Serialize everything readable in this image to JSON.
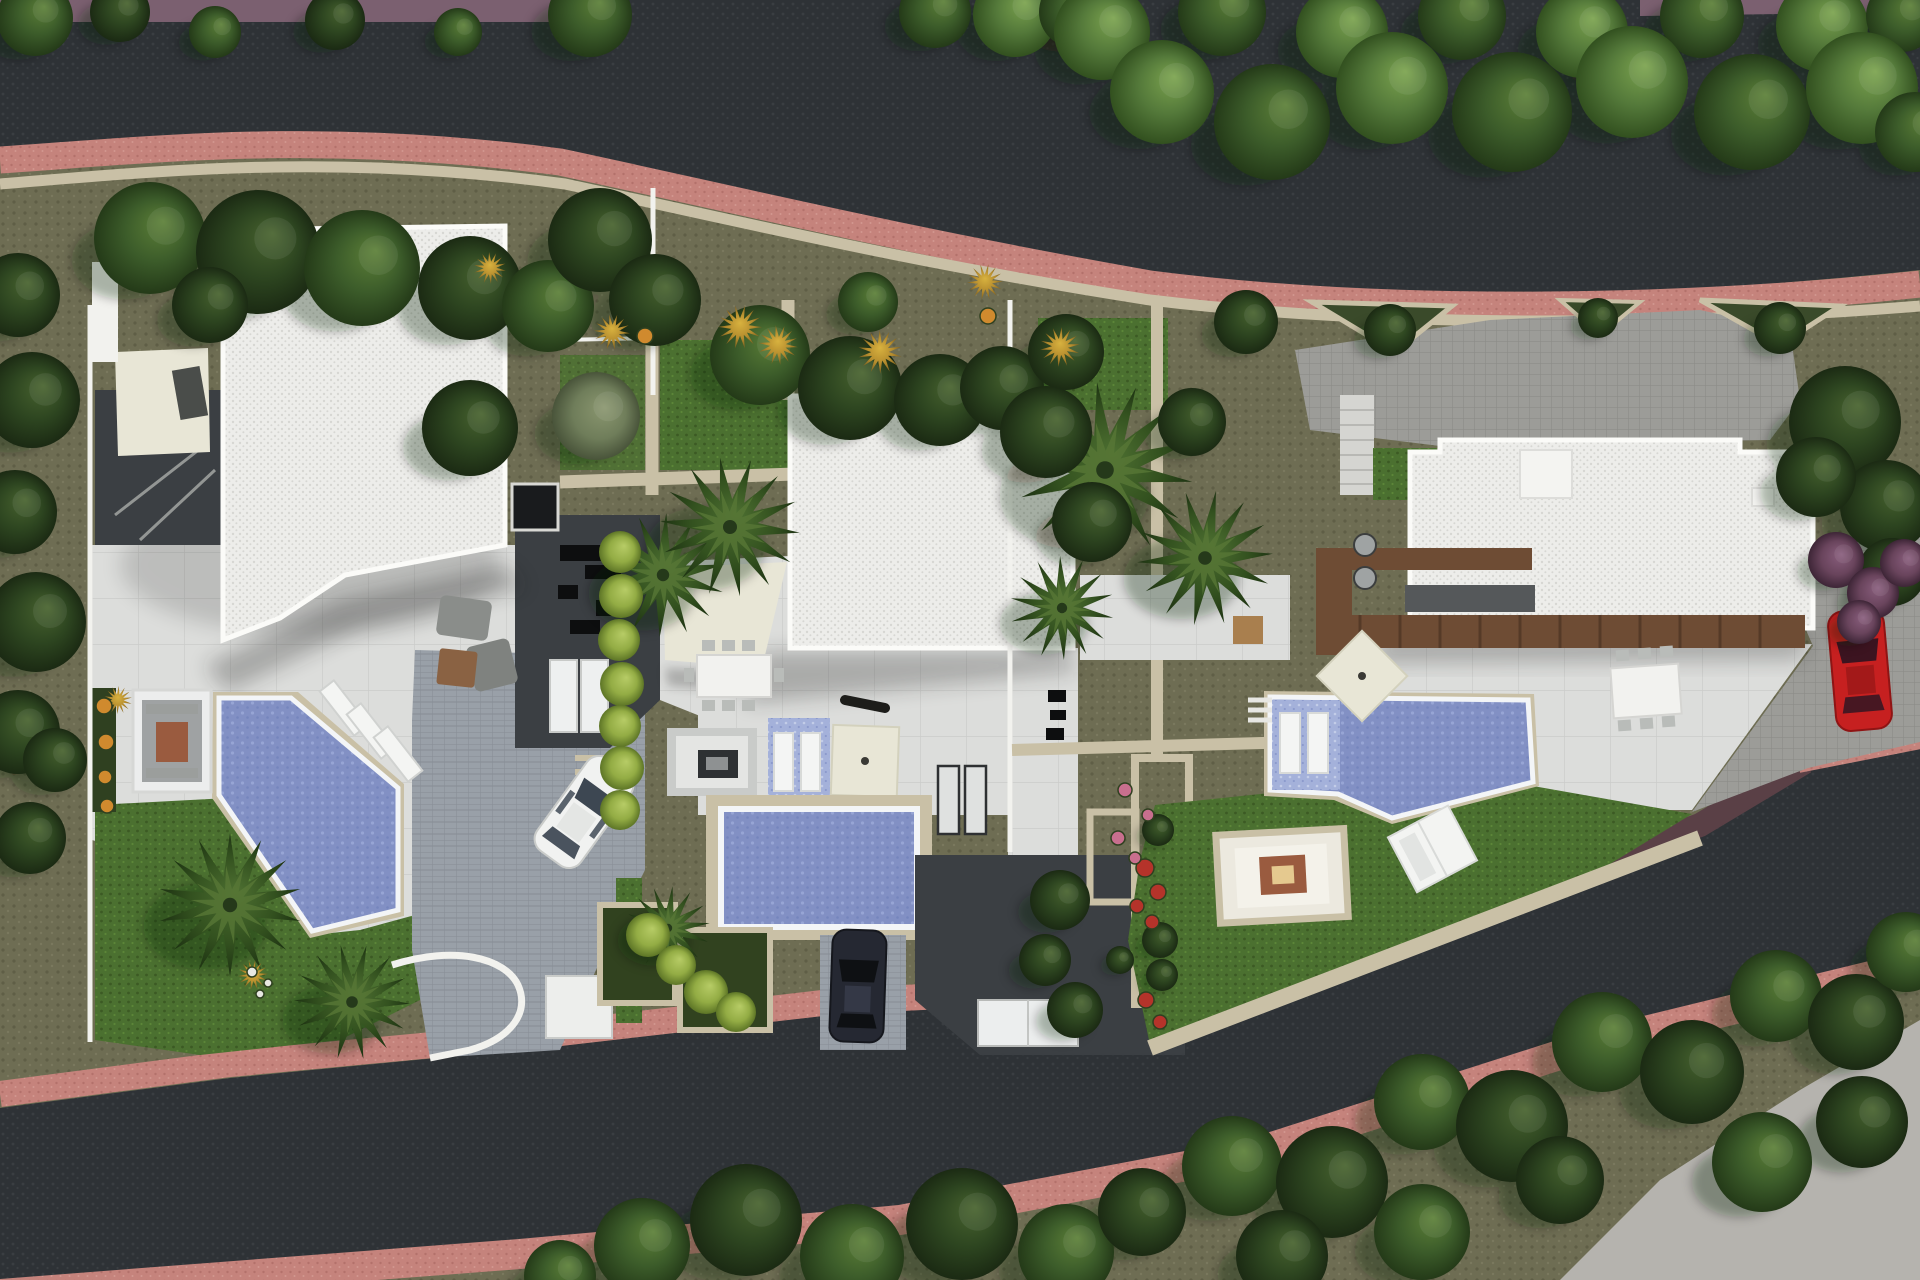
{
  "meta": {
    "type": "architectural-aerial-render",
    "description": "Top-down 3D rendering of a residential site plan: three modern white flat-roof villas with angular blue pools, lawns, palm trees, paved terraces, driveways with parked cars, bounded by two curving asphalt roads with salmon-pink sidewalks and dense tree lines.",
    "width": 1920,
    "height": 1280
  },
  "palette": {
    "asphalt": "#2e3236",
    "asphaltDot": "#3a3e42",
    "sidewalkPink": "#c5837c",
    "sidewalkPinkDark": "#b3716b",
    "boundaryMaroon": "#5a4046",
    "pathPurple": "#7b6070",
    "stoneBeige": "#c9c0a6",
    "stoneBright": "#d9d1b9",
    "groundOlive": "#6e6d53",
    "groundOliveDot": "#5f5e46",
    "shadedGarden": "#232d1a",
    "lawn": "#4b7030",
    "lawnDark": "#3c5a24",
    "lawnLight": "#5c8638",
    "roofWhite": "#EDEDEA",
    "roofDot": "#d7d7d3",
    "roofFascia": "#fbfbf8",
    "terrace": "#DCDDDB",
    "terraceLine": "#cbccca",
    "paverGray": "#9c9c98",
    "paverLine": "#8b8b87",
    "paverCool": "#99a0a8",
    "paverCoolLine": "#868d95",
    "courtDark": "#3b3f43",
    "skylight": "#191b1d",
    "water": "#8290c4",
    "waterDot": "#97a5d4",
    "splash": "#a4b1da",
    "poolRim": "#f3f5f7",
    "concreteLight": "#b5b3ae",
    "wood": "#6e4c34",
    "woodLight": "#8a6243",
    "rustFire": "#9a5b3f",
    "canvasCream": "#e8e6d6",
    "carWhite": "#f1f2f1",
    "carDark": "#252832",
    "carRed": "#c62020",
    "wallWhite": "#f2f2ee",
    "furnGray": "#85888a"
  },
  "scene": {
    "roads": {
      "upper": {
        "surface": "dark asphalt",
        "sidewalk": "salmon pink strip on lower edge",
        "edge_wall": "beige stone"
      },
      "lower": {
        "surface": "dark asphalt",
        "sidewalk": "salmon pink strips both edges",
        "edge_wall": "dark maroon boundary wall"
      }
    },
    "villas": [
      {
        "id": "left",
        "roof": "white gravel flat roof",
        "pool": "angular diagonal pool",
        "features": [
          "sunken fire-pit lounge",
          "three sun loungers",
          "carport canopy",
          "paver driveway",
          "white compact car",
          "palm lawn"
        ]
      },
      {
        "id": "middle",
        "roof": "large white gravel flat roof",
        "pool": "rectangular pool with tiled splash deck",
        "features": [
          "shade sail",
          "outdoor dining table",
          "lounge with fire table",
          "square parasol",
          "dark car on driveway",
          "hedge row"
        ]
      },
      {
        "id": "right",
        "roof": "L-shaped white gravel flat roof",
        "pool": "angular infinity pool with splash deck",
        "features": [
          "timber pergola",
          "outdoor dining table",
          "sunken fire-pit lounge",
          "double sun lounger",
          "gray paver parking",
          "red car"
        ]
      }
    ],
    "cars": [
      {
        "id": "white-car",
        "color": "white",
        "transform": "translate(584,812) rotate(36)"
      },
      {
        "id": "dark-car",
        "color": "dark navy",
        "transform": "translate(858,986) rotate(2)"
      },
      {
        "id": "red-car",
        "color": "red",
        "transform": "translate(1860,670) rotate(-5)"
      }
    ],
    "vegetation": {
      "trees": [
        [
          35,
          18,
          38,
          1
        ],
        [
          120,
          12,
          30,
          0
        ],
        [
          215,
          32,
          26,
          1
        ],
        [
          335,
          20,
          30,
          0
        ],
        [
          458,
          32,
          24,
          1
        ],
        [
          590,
          15,
          42,
          1
        ],
        [
          935,
          12,
          36,
          1
        ],
        [
          1015,
          15,
          42,
          2
        ],
        [
          1075,
          12,
          36,
          1
        ],
        [
          1102,
          32,
          48,
          2
        ],
        [
          1222,
          12,
          44,
          1
        ],
        [
          1342,
          32,
          46,
          2
        ],
        [
          1462,
          16,
          44,
          1
        ],
        [
          1582,
          32,
          46,
          2
        ],
        [
          1702,
          16,
          42,
          1
        ],
        [
          1822,
          26,
          46,
          2
        ],
        [
          1902,
          16,
          36,
          1
        ],
        [
          1162,
          92,
          52,
          2
        ],
        [
          1272,
          122,
          58,
          1
        ],
        [
          1392,
          88,
          56,
          2
        ],
        [
          1512,
          112,
          60,
          1
        ],
        [
          1632,
          82,
          56,
          2
        ],
        [
          1752,
          112,
          58,
          1
        ],
        [
          1862,
          88,
          56,
          2
        ],
        [
          1915,
          132,
          40,
          1
        ],
        [
          18,
          295,
          42,
          0
        ],
        [
          32,
          400,
          48,
          0
        ],
        [
          15,
          512,
          42,
          0
        ],
        [
          36,
          622,
          50,
          0
        ],
        [
          18,
          732,
          42,
          0
        ],
        [
          30,
          838,
          36,
          0
        ],
        [
          55,
          760,
          32,
          0
        ],
        [
          150,
          238,
          56,
          1
        ],
        [
          258,
          252,
          62,
          0
        ],
        [
          362,
          268,
          58,
          1
        ],
        [
          470,
          288,
          52,
          0
        ],
        [
          548,
          306,
          46,
          1
        ],
        [
          210,
          305,
          38,
          0
        ],
        [
          600,
          240,
          52,
          0
        ],
        [
          655,
          300,
          46,
          0
        ],
        [
          760,
          355,
          50,
          1
        ],
        [
          850,
          388,
          52,
          0
        ],
        [
          940,
          400,
          46,
          0
        ],
        [
          1002,
          388,
          42,
          0
        ],
        [
          1066,
          352,
          38,
          0
        ],
        [
          868,
          302,
          30,
          1
        ],
        [
          596,
          416,
          44,
          3
        ],
        [
          470,
          428,
          48,
          0
        ],
        [
          1046,
          432,
          46,
          0
        ],
        [
          1092,
          522,
          40,
          0
        ],
        [
          1192,
          422,
          34,
          0
        ],
        [
          1246,
          322,
          32,
          0
        ],
        [
          1390,
          330,
          26,
          0
        ],
        [
          1780,
          328,
          26,
          0
        ],
        [
          1598,
          318,
          20,
          0
        ],
        [
          1845,
          422,
          56,
          0
        ],
        [
          1886,
          506,
          46,
          0
        ],
        [
          1816,
          477,
          40,
          0
        ],
        [
          1892,
          572,
          34,
          0
        ],
        [
          1836,
          560,
          28,
          4
        ],
        [
          1873,
          593,
          26,
          4
        ],
        [
          1904,
          563,
          24,
          4
        ],
        [
          1859,
          622,
          22,
          4
        ],
        [
          642,
          1246,
          48,
          1
        ],
        [
          746,
          1220,
          56,
          0
        ],
        [
          852,
          1256,
          52,
          1
        ],
        [
          962,
          1224,
          56,
          0
        ],
        [
          1066,
          1252,
          48,
          1
        ],
        [
          1142,
          1212,
          44,
          0
        ],
        [
          560,
          1276,
          36,
          1
        ],
        [
          1232,
          1166,
          50,
          1
        ],
        [
          1332,
          1182,
          56,
          0
        ],
        [
          1422,
          1102,
          48,
          1
        ],
        [
          1512,
          1126,
          56,
          0
        ],
        [
          1602,
          1042,
          50,
          1
        ],
        [
          1692,
          1072,
          52,
          0
        ],
        [
          1776,
          996,
          46,
          1
        ],
        [
          1856,
          1022,
          48,
          0
        ],
        [
          1906,
          952,
          40,
          1
        ],
        [
          1762,
          1162,
          50,
          1
        ],
        [
          1862,
          1122,
          46,
          0
        ],
        [
          1282,
          1256,
          46,
          0
        ],
        [
          1422,
          1232,
          48,
          1
        ],
        [
          1560,
          1180,
          44,
          0
        ],
        [
          1160,
          940,
          18,
          0
        ],
        [
          1162,
          975,
          16,
          0
        ],
        [
          1158,
          830,
          16,
          0
        ],
        [
          1120,
          960,
          14,
          0
        ],
        [
          1060,
          900,
          30,
          0
        ],
        [
          1045,
          960,
          26,
          0
        ],
        [
          1075,
          1010,
          28,
          0
        ]
      ],
      "palms": [
        [
          230,
          905,
          72
        ],
        [
          352,
          1002,
          58
        ],
        [
          663,
          575,
          62
        ],
        [
          730,
          527,
          70
        ],
        [
          668,
          928,
          42
        ],
        [
          1105,
          470,
          88
        ],
        [
          1205,
          558,
          68
        ],
        [
          1062,
          608,
          52
        ]
      ],
      "shrubs": [
        [
          620,
          552,
          21,
          0
        ],
        [
          621,
          596,
          22,
          0
        ],
        [
          619,
          640,
          21,
          0
        ],
        [
          622,
          684,
          22,
          0
        ],
        [
          620,
          726,
          21,
          0
        ],
        [
          622,
          768,
          22,
          0
        ],
        [
          620,
          810,
          20,
          0
        ],
        [
          648,
          935,
          22,
          0
        ],
        [
          676,
          965,
          20,
          0
        ],
        [
          706,
          992,
          22,
          0
        ],
        [
          736,
          1012,
          20,
          0
        ],
        [
          740,
          327,
          22,
          1
        ],
        [
          778,
          345,
          20,
          1
        ],
        [
          880,
          352,
          22,
          1
        ],
        [
          1060,
          347,
          20,
          1
        ],
        [
          985,
          282,
          18,
          1
        ],
        [
          612,
          332,
          18,
          1
        ],
        [
          490,
          268,
          16,
          1
        ],
        [
          118,
          700,
          14,
          1
        ],
        [
          253,
          975,
          15,
          1
        ]
      ],
      "flowers": [
        [
          104,
          706,
          8,
          0
        ],
        [
          106,
          742,
          8,
          0
        ],
        [
          105,
          777,
          7,
          0
        ],
        [
          107,
          806,
          7,
          0
        ],
        [
          645,
          336,
          8,
          0
        ],
        [
          988,
          316,
          8,
          0
        ],
        [
          1145,
          868,
          9,
          1
        ],
        [
          1158,
          892,
          8,
          1
        ],
        [
          1137,
          906,
          7,
          1
        ],
        [
          1152,
          922,
          7,
          1
        ],
        [
          1146,
          1000,
          8,
          1
        ],
        [
          1160,
          1022,
          7,
          1
        ],
        [
          1125,
          790,
          7,
          2
        ],
        [
          1148,
          815,
          6,
          2
        ],
        [
          1118,
          838,
          7,
          2
        ],
        [
          1135,
          858,
          6,
          2
        ],
        [
          252,
          972,
          5,
          3
        ],
        [
          268,
          983,
          4,
          3
        ],
        [
          260,
          994,
          4,
          3
        ]
      ]
    }
  }
}
